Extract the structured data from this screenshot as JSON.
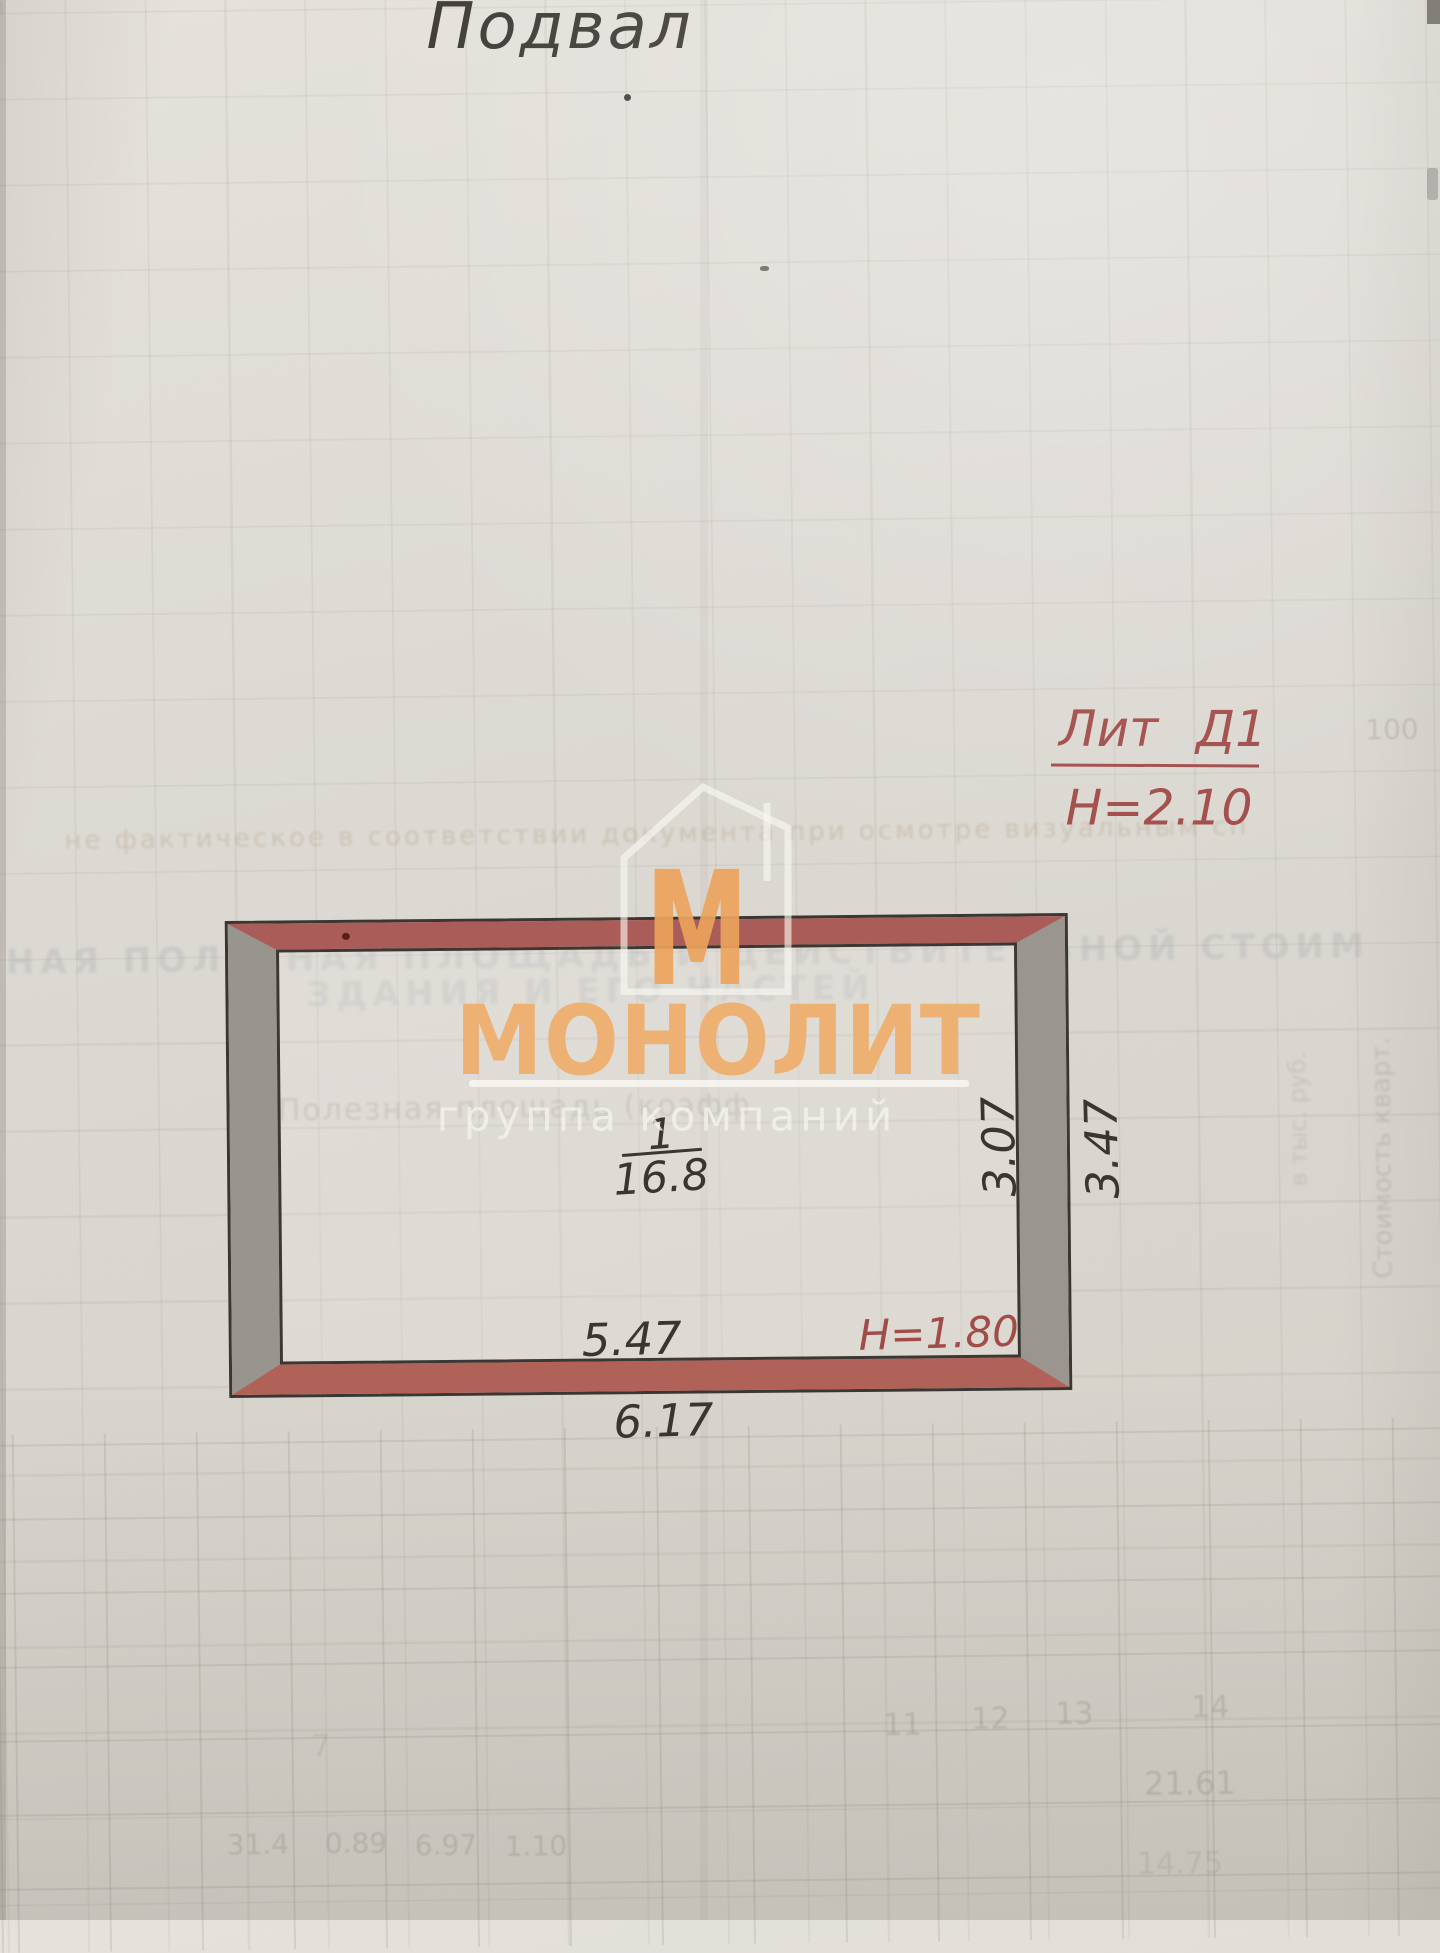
{
  "title": "Подвал",
  "litera": {
    "label": "Лит Д1",
    "height": "Н=2.10"
  },
  "room": {
    "number": "1",
    "area": "16.8"
  },
  "dims": {
    "bottom_inner": "5.47",
    "bottom_outer": "6.17",
    "right_inner": "3.07",
    "right_outer": "3.47",
    "height_note": "Н=1.80"
  },
  "watermark": {
    "letter": "М",
    "brand": "МОНОЛИТ",
    "tagline": "группа компаний",
    "accent_color": "#efaa68"
  },
  "plan_colors": {
    "wall_horizontal": "#aa5d58",
    "wall_vertical": "#98948e",
    "outline": "#3a3631",
    "annotation_red": "#a14c49"
  },
  "bleed": {
    "top_left": "ия",
    "row1": "не фактическое в соответствии документа при осмотре визуальным сп",
    "row2": "НАЯ ПОЛЕЗНАЯ ПЛОЩАДЬ И ДЕЙСТВИТЕЛЬНОЙ СТОИМ",
    "row3": "ЗДАНИЯ И ЕГО ЧАСТЕЙ",
    "row4": "Полезная площадь (коэфф",
    "side1": "Стоимость кварт.",
    "side2": "в тыс. руб.",
    "num_100": "100",
    "header_nums": [
      "11",
      "12",
      "13",
      "14"
    ],
    "num_a": "21.61",
    "num_b": "14.75",
    "num_c": "7",
    "bottom_nums": [
      "31.4",
      "0.89",
      "6.97",
      "1.10"
    ]
  }
}
